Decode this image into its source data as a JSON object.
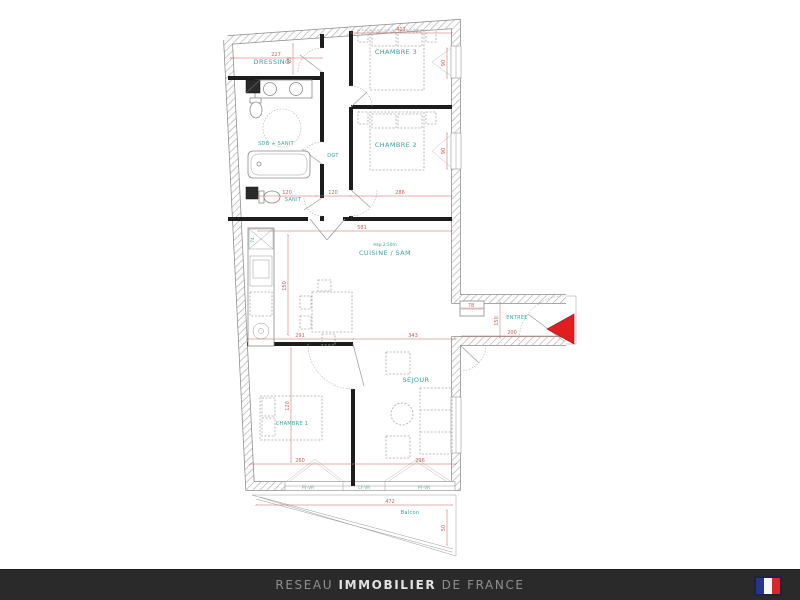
{
  "plan": {
    "rooms": {
      "dressing": {
        "label": "DRESSING"
      },
      "chambre3": {
        "label": "CHAMBRE 3"
      },
      "sdb": {
        "label": "SDB + SANIT"
      },
      "dgt": {
        "label": "DGT"
      },
      "sanit": {
        "label": "SANIT"
      },
      "chambre2": {
        "label": "CHAMBRE 2"
      },
      "cuisine": {
        "label": "CUISINE / SAM",
        "height_note": "Hsp 2.50m"
      },
      "entree": {
        "label": "ENTREE"
      },
      "sejour": {
        "label": "SEJOUR"
      },
      "chambre1": {
        "label": "CHAMBRE 1"
      },
      "balcon": {
        "label": "Balcon"
      }
    },
    "dims": {
      "top_dressing": "227",
      "top_chambre3": "411",
      "sanit_width": "120",
      "dgt_width": "120",
      "chambre2_width": "286",
      "cuisine_width": "581",
      "cuisine_lower_left": "291",
      "cuisine_lower_right": "343",
      "entree_closet": "78",
      "entree_width": "200",
      "chambre1_width": "260",
      "sejour_width": "296",
      "balcon_width": "472",
      "dressing_height": "85",
      "window_chambre3": "90",
      "window_chambre2": "90",
      "entree_depth": "150",
      "kitchen_run": "150",
      "chambre1_depth": "120",
      "balcon_depth": "50",
      "kitchen_counter": "74"
    },
    "windows": {
      "left": "PF-VR",
      "center": "CF-VR",
      "right": "PF-VR"
    },
    "colors": {
      "room_label": "#3f9f9f",
      "dimension": "#c4625c",
      "entrance_arrow": "#e21d1d",
      "wall_hatch": "#b0b0b0"
    }
  },
  "footer": {
    "prefix": "RESEAU",
    "main": "IMMOBILIER",
    "suffix": "DE FRANCE",
    "flag_icon": "france-flag-icon",
    "flag_colors": {
      "blue": "#26348c",
      "white": "#f5f5f5",
      "red": "#d8262c"
    },
    "background": "#2a2a2a"
  }
}
